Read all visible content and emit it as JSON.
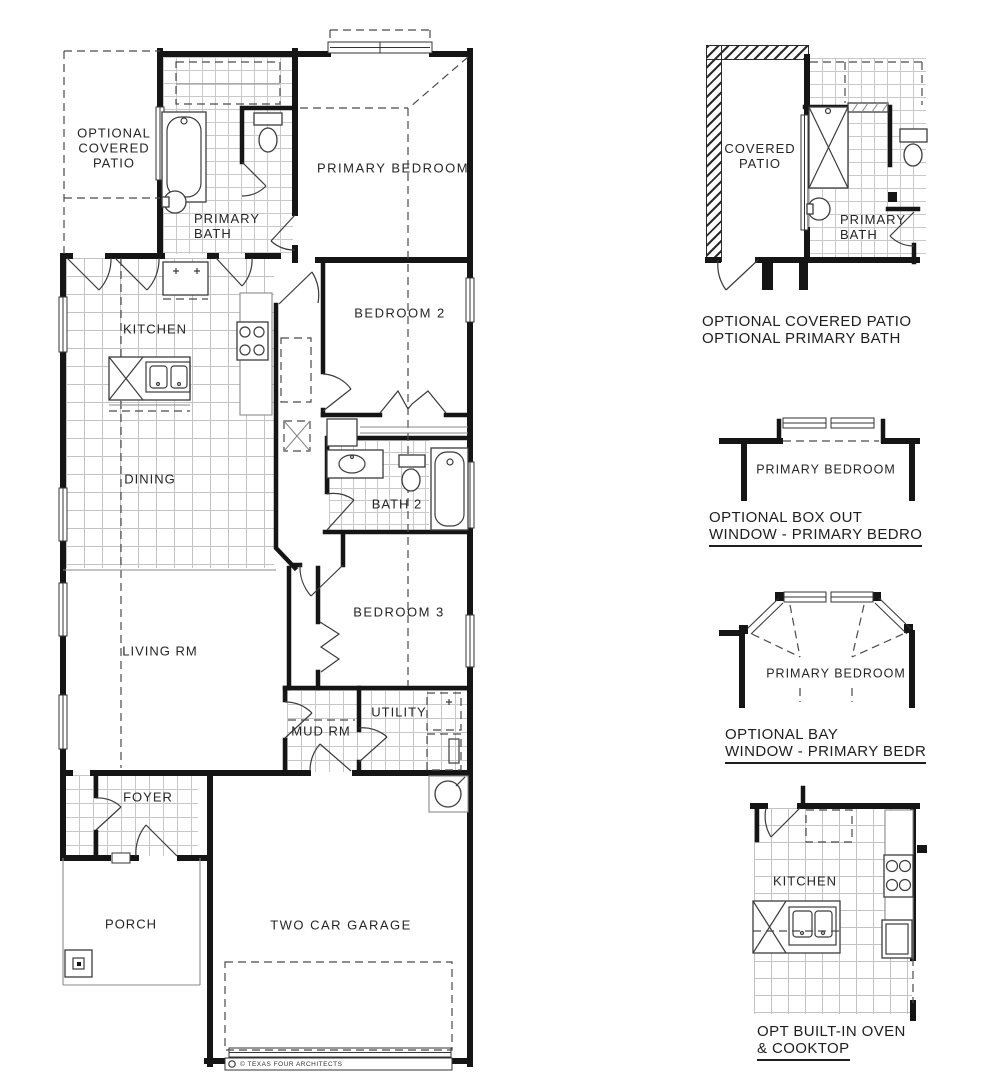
{
  "title_block": {
    "credit": "© TEXAS FOUR ARCHITECTS"
  },
  "main_plan": {
    "rooms": {
      "optional_covered_patio": {
        "line1": "OPTIONAL",
        "line2": "COVERED",
        "line3": "PATIO"
      },
      "primary_bath": {
        "line1": "PRIMARY",
        "line2": "BATH"
      },
      "primary_bedroom": "PRIMARY BEDROOM",
      "kitchen": "KITCHEN",
      "bedroom_2": "BEDROOM 2",
      "dining": "DINING",
      "bath_2": "BATH 2",
      "bedroom_3": "BEDROOM 3",
      "living_rm": "LIVING RM",
      "mud_rm": "MUD RM",
      "utility": "UTILITY",
      "foyer": "FOYER",
      "porch": "PORCH",
      "garage": "TWO CAR GARAGE"
    }
  },
  "options": {
    "patio_bath": {
      "rooms": {
        "covered_patio": {
          "line1": "COVERED",
          "line2": "PATIO"
        },
        "primary_bath": {
          "line1": "PRIMARY",
          "line2": "BATH"
        }
      },
      "caption_line1": "OPTIONAL COVERED PATIO",
      "caption_line2": "OPTIONAL PRIMARY BATH"
    },
    "box_out_window": {
      "room": "PRIMARY BEDROOM",
      "caption_line1": "OPTIONAL BOX OUT",
      "caption_line2": "WINDOW - PRIMARY BEDRO"
    },
    "bay_window": {
      "room": "PRIMARY BEDROOM",
      "caption_line1": "OPTIONAL BAY",
      "caption_line2": "WINDOW - PRIMARY BEDR"
    },
    "oven_cooktop": {
      "room": "KITCHEN",
      "caption_line1": "OPT BUILT-IN OVEN",
      "caption_line2": "& COOKTOP"
    }
  },
  "colors": {
    "wall": "#151515",
    "fixture": "#3c3c3c",
    "dashed_line": "#4a4a4a",
    "tile_line": "#c7c7c7",
    "background": "#ffffff"
  }
}
